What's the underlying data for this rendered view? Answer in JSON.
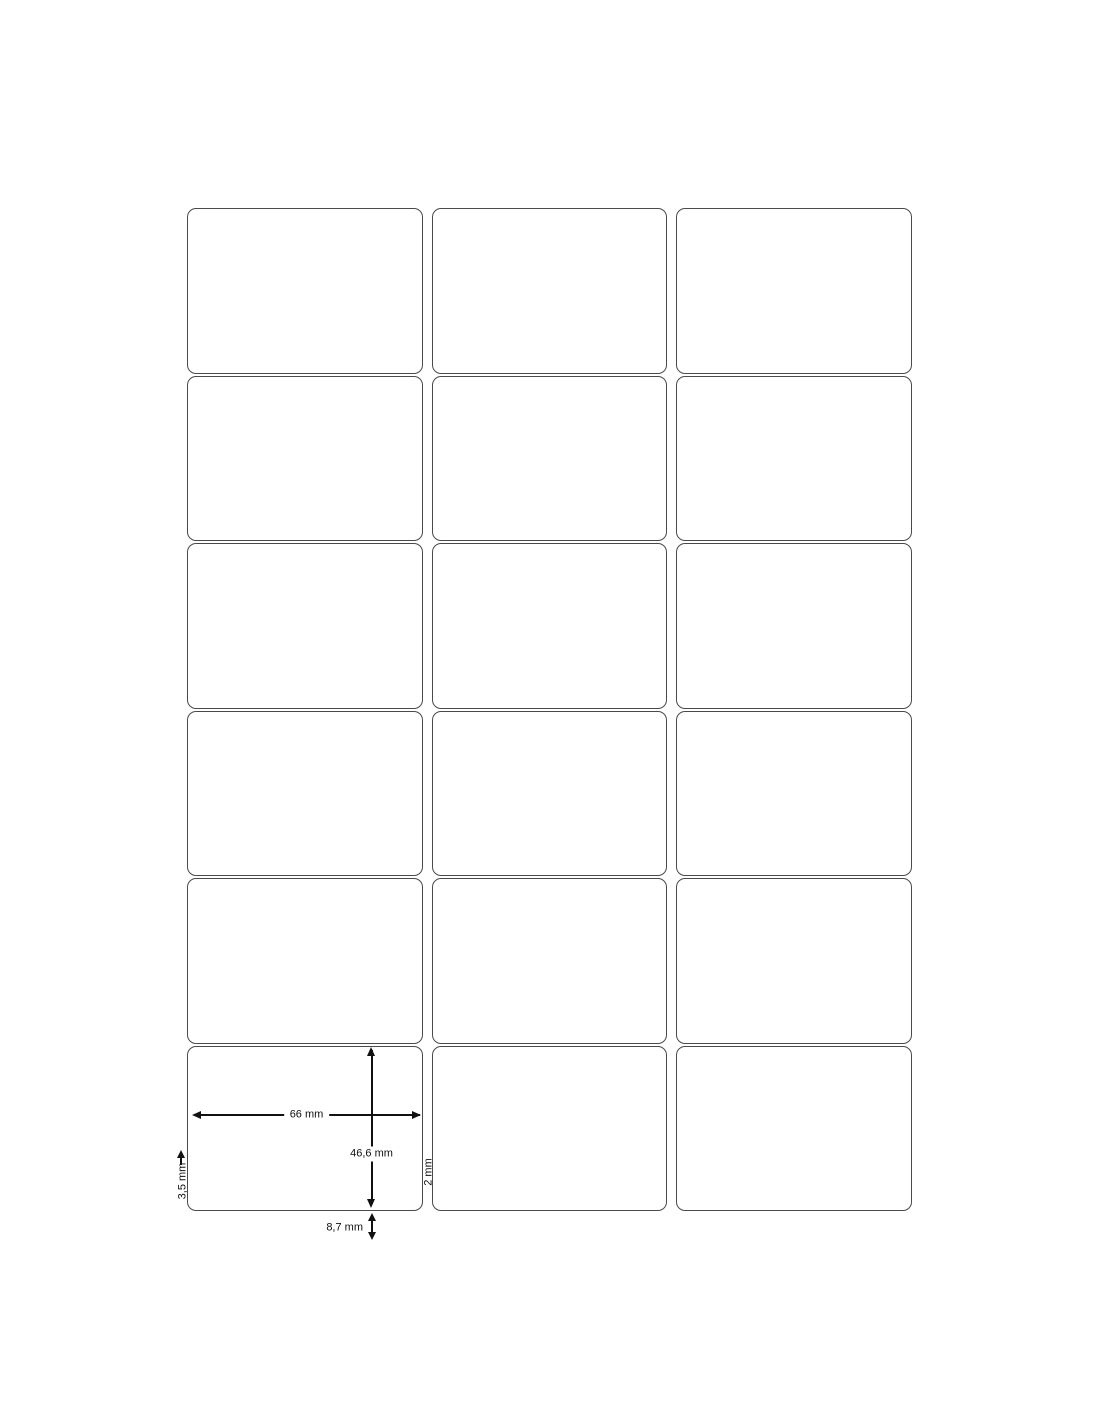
{
  "diagram": {
    "type": "label-sheet-template",
    "rows": 6,
    "columns": 3,
    "label_count": 18
  },
  "dimensions": {
    "label_width": "66 mm",
    "label_height": "46,6 mm",
    "side_margin": "3,5 mm",
    "column_gap": "2 mm",
    "bottom_margin": "8,7 mm"
  },
  "colors": {
    "background": "#ffffff",
    "label_border": "#4a4a4a",
    "label_fill": "#ffffff",
    "annotation": "#111111"
  }
}
